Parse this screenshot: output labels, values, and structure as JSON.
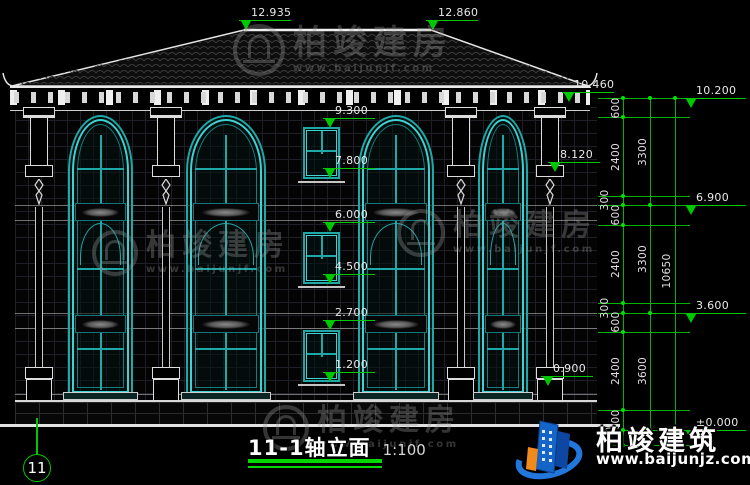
{
  "titlebar": {
    "title": "11-1轴立面",
    "scale": "1:100"
  },
  "axis": {
    "bubble": "11"
  },
  "levels": {
    "ridge_left": "12.935",
    "ridge_right": "12.860",
    "eave": "10.460",
    "wall_top": "8.120",
    "plinth": "0.900",
    "window": [
      "9.300",
      "7.800",
      "6.000",
      "4.500",
      "2.700",
      "1.200"
    ],
    "right": [
      "10.200",
      "6.900",
      "3.600",
      "±0.000"
    ]
  },
  "dims": {
    "inner": [
      "600",
      "2400",
      "300",
      "600",
      "2400",
      "300",
      "600",
      "2400",
      "600",
      "450"
    ],
    "floors": [
      "3300",
      "3300",
      "3600"
    ],
    "total": "10650"
  },
  "watermark": {
    "name": "柏竣建房",
    "url": "www.baijunjf.com"
  },
  "brand": {
    "name": "柏竣建筑",
    "url": "www.baijunjz.com"
  },
  "colors": {
    "dim_green": "#00c800",
    "window_teal": "#1fa8a8",
    "line_white": "#e8e8e8",
    "brand_blue": "#1565c8",
    "brand_orange": "#f08a1d",
    "watermark_gray": "#9a9a9a"
  }
}
